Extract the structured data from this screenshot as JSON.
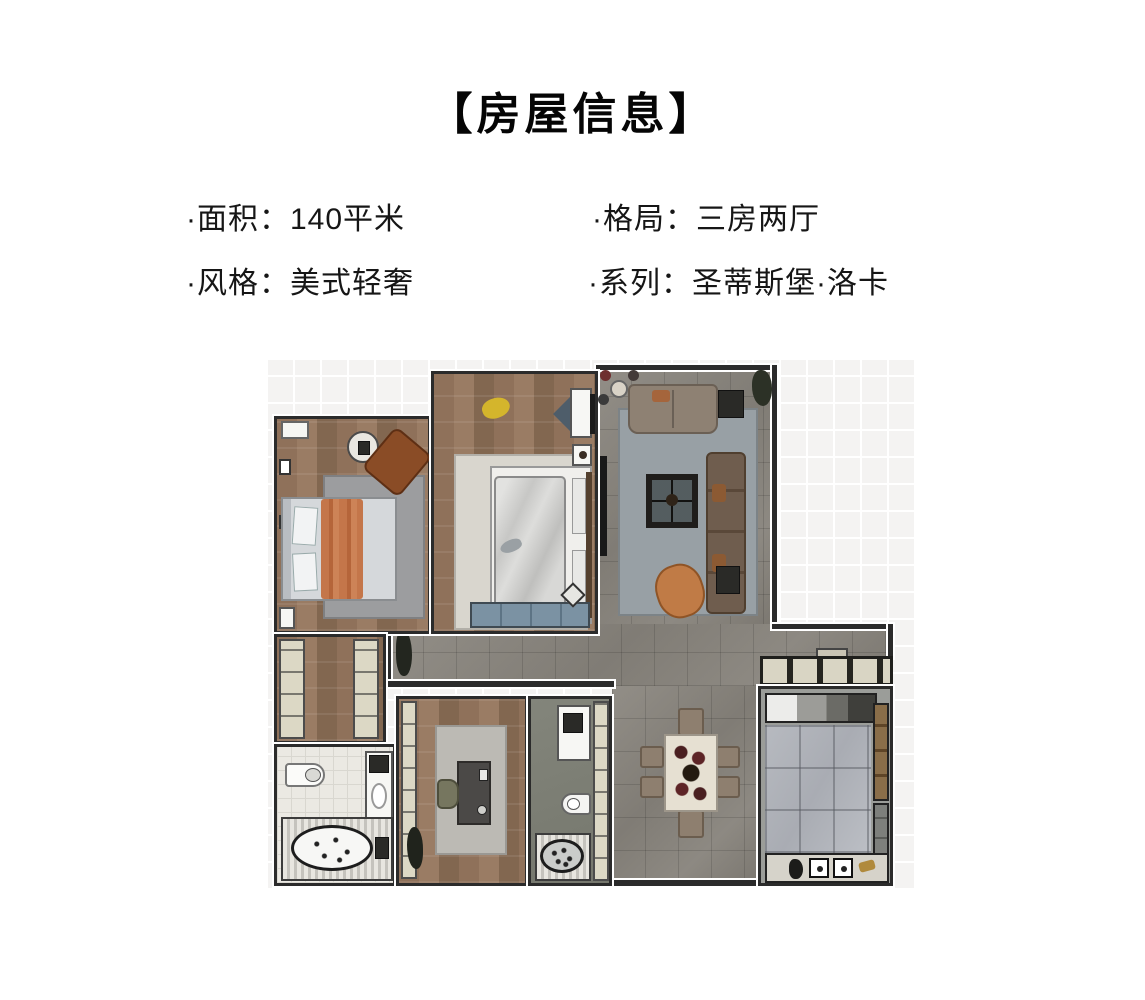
{
  "header": {
    "title": "【房屋信息】"
  },
  "info": {
    "items": [
      {
        "label": "面积",
        "value": "140平米",
        "text": "·面积：140平米"
      },
      {
        "label": "格局",
        "value": "三房两厅",
        "text": "·格局：三房两厅"
      },
      {
        "label": "风格",
        "value": "美式轻奢",
        "text": "·风格：美式轻奢"
      },
      {
        "label": "系列",
        "value": "圣蒂斯堡·洛卡",
        "text": "·系列：圣蒂斯堡·洛卡"
      }
    ]
  },
  "floor_plan": {
    "description": "top-view rendered apartment floor plan, no text labels",
    "rooms": [
      {
        "name": "master-bedroom",
        "floor": "wood",
        "furniture": [
          "double-bed-orange-throw",
          "gray-rug",
          "brown-armchair",
          "round-side-table",
          "wall-art",
          "nightstand"
        ]
      },
      {
        "name": "second-bedroom",
        "floor": "wood",
        "furniture": [
          "double-bed-gray-duvet",
          "cream-rug",
          "yellow-toy",
          "blue-floor-cushion",
          "tv-console",
          "blue-bench"
        ]
      },
      {
        "name": "living-room",
        "floor": "gray-tile",
        "furniture": [
          "loveseat-sofa",
          "long-sofa",
          "coffee-table",
          "orange-armchair",
          "side-tables",
          "plant",
          "tv-panel",
          "entry-bistro-set"
        ]
      },
      {
        "name": "wardrobe-hallway",
        "floor": "wood",
        "furniture": [
          "closet-column-left",
          "closet-column-right"
        ]
      },
      {
        "name": "bathroom-main",
        "floor": "white-tile",
        "furniture": [
          "toilet",
          "vanity-sink",
          "appliance",
          "oval-bathtub"
        ]
      },
      {
        "name": "study",
        "floor": "wood",
        "furniture": [
          "rug",
          "desk",
          "chair",
          "cabinet-column",
          "plant"
        ]
      },
      {
        "name": "bathroom-second",
        "floor": "gray",
        "furniture": [
          "vanity",
          "toilet",
          "oval-bathtub",
          "storage-column"
        ]
      },
      {
        "name": "dining-area",
        "floor": "gray-tile",
        "furniture": [
          "dining-table-floral",
          "six-chairs"
        ]
      },
      {
        "name": "kitchen",
        "floor": "marble",
        "furniture": [
          "upper-cabinet-row",
          "counter-with-stove",
          "tall-brown-cabinets",
          "sink-counter",
          "gold-faucet"
        ]
      }
    ],
    "colors": {
      "wood_floor": "#8f715a",
      "gray_tile": "#86827b",
      "white_tile": "#ebe9e3",
      "kitchen_marble": "#b2b5bb",
      "rug_gray": "#9aa0a5",
      "rug_cream": "#d9d6ce",
      "sofa_brown": "#6f5d4e",
      "accent_orange": "#c07b46",
      "bench_blue": "#7b92a3",
      "wall_line": "#2b2b2b",
      "background_grid": "#f4f3f2"
    }
  }
}
